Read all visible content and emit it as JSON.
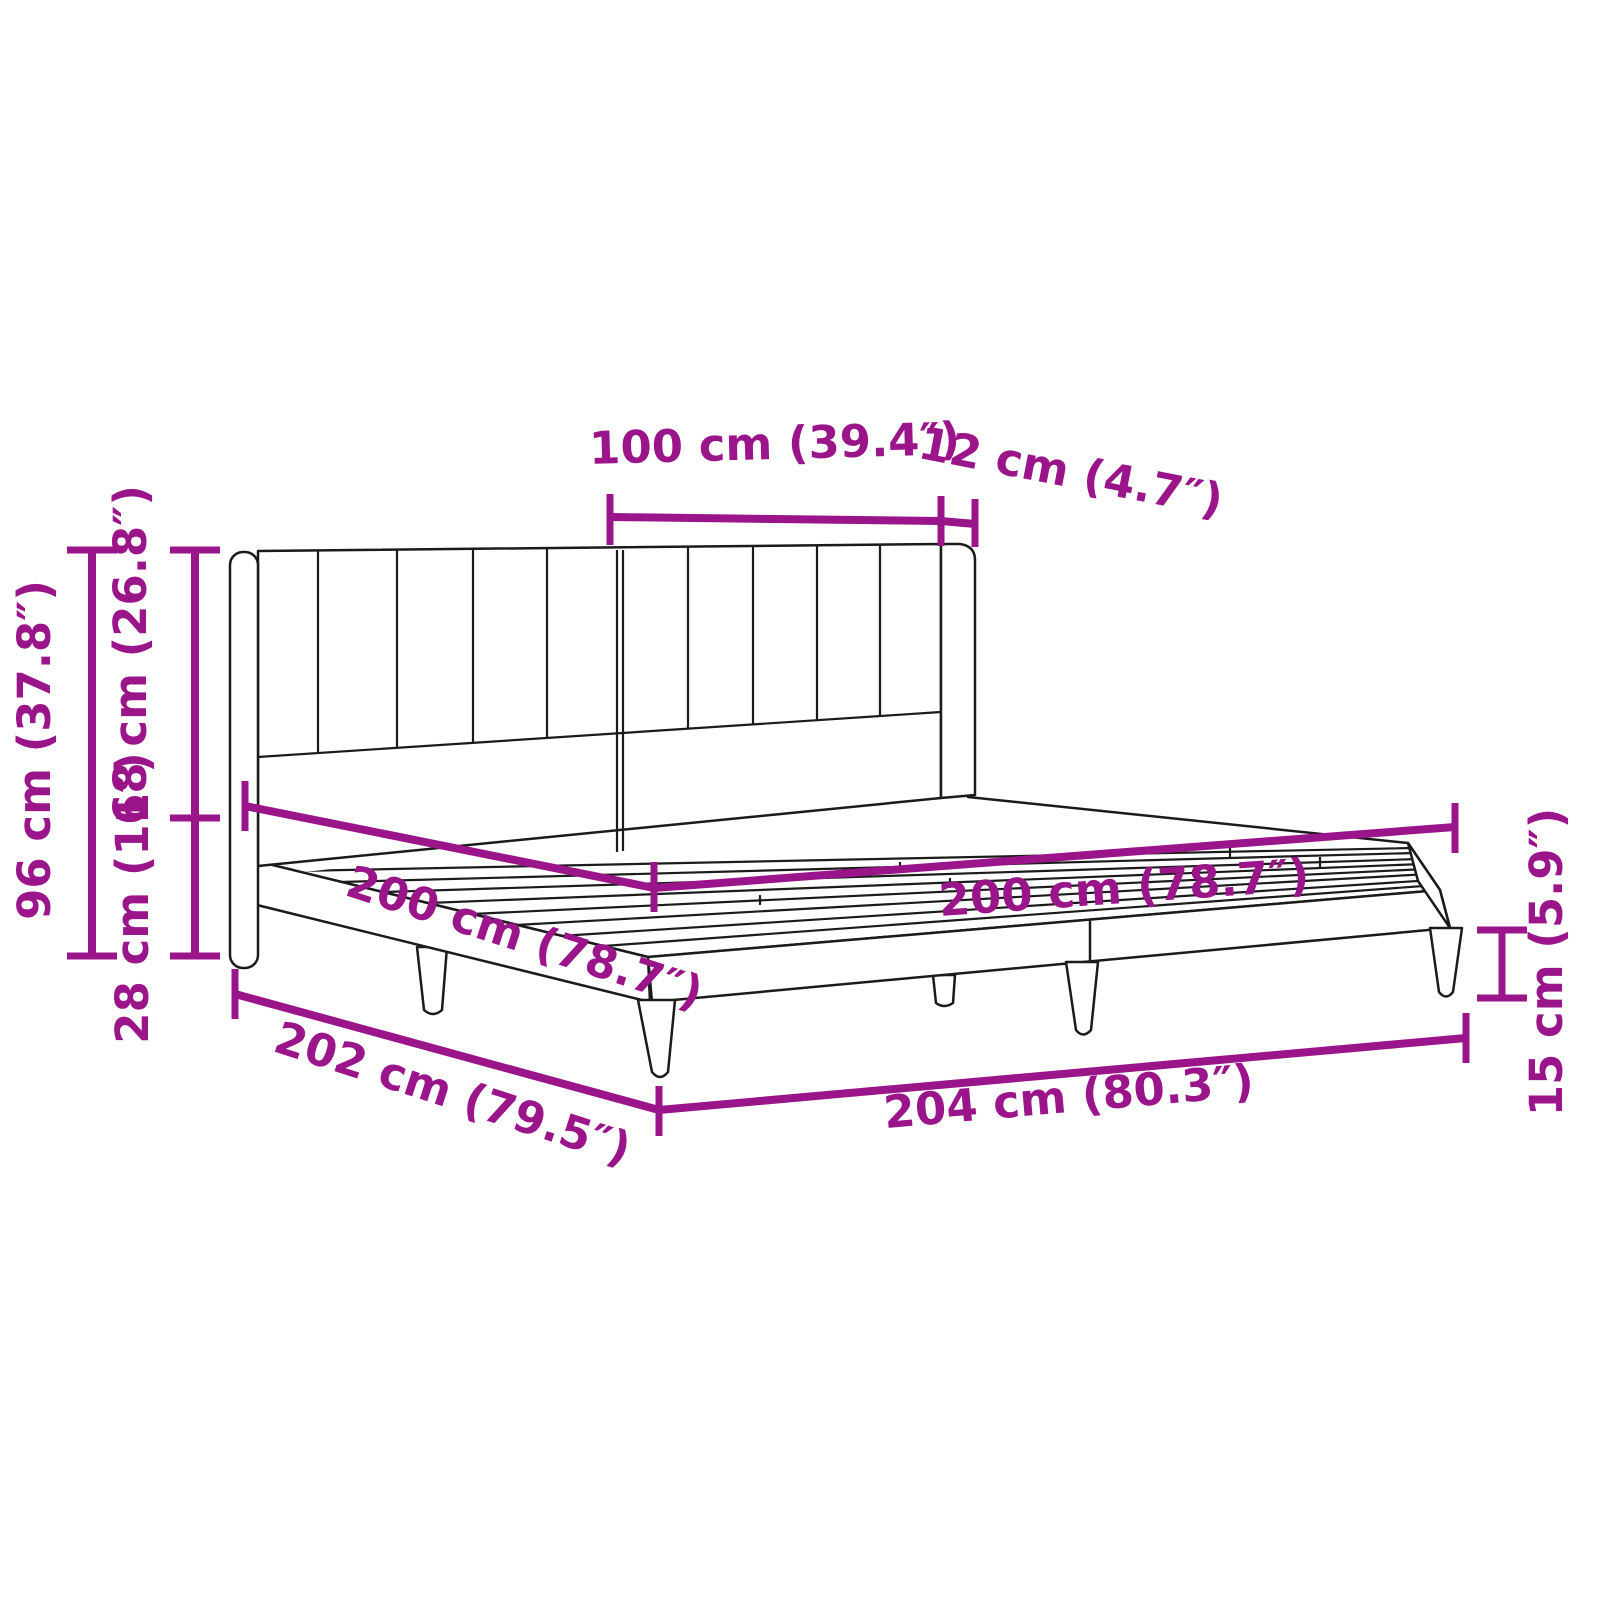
{
  "diagram": {
    "type": "furniture-dimension-diagram",
    "subject": "bed frame with winged channel-tufted headboard, slatted base and tapered legs",
    "colors": {
      "dimension_color": "#9A148A",
      "linework_color": "#1b1b1b",
      "background_color": "#ffffff"
    },
    "dimensions": {
      "headboard_panel_width": "100 cm (39.4″)",
      "headboard_wing_thickness": "12 cm (4.7″)",
      "total_height": "96 cm (37.8″)",
      "headboard_height_above_frame": "68 cm (26.8″)",
      "frame_height": "28 cm (11″)",
      "bed_width": "200 cm (78.7″)",
      "bed_length": "200 cm (78.7″)",
      "frame_outer_width": "202 cm (79.5″)",
      "frame_outer_length": "204 cm (80.3″)",
      "leg_height": "15 cm (5.9″)"
    }
  }
}
